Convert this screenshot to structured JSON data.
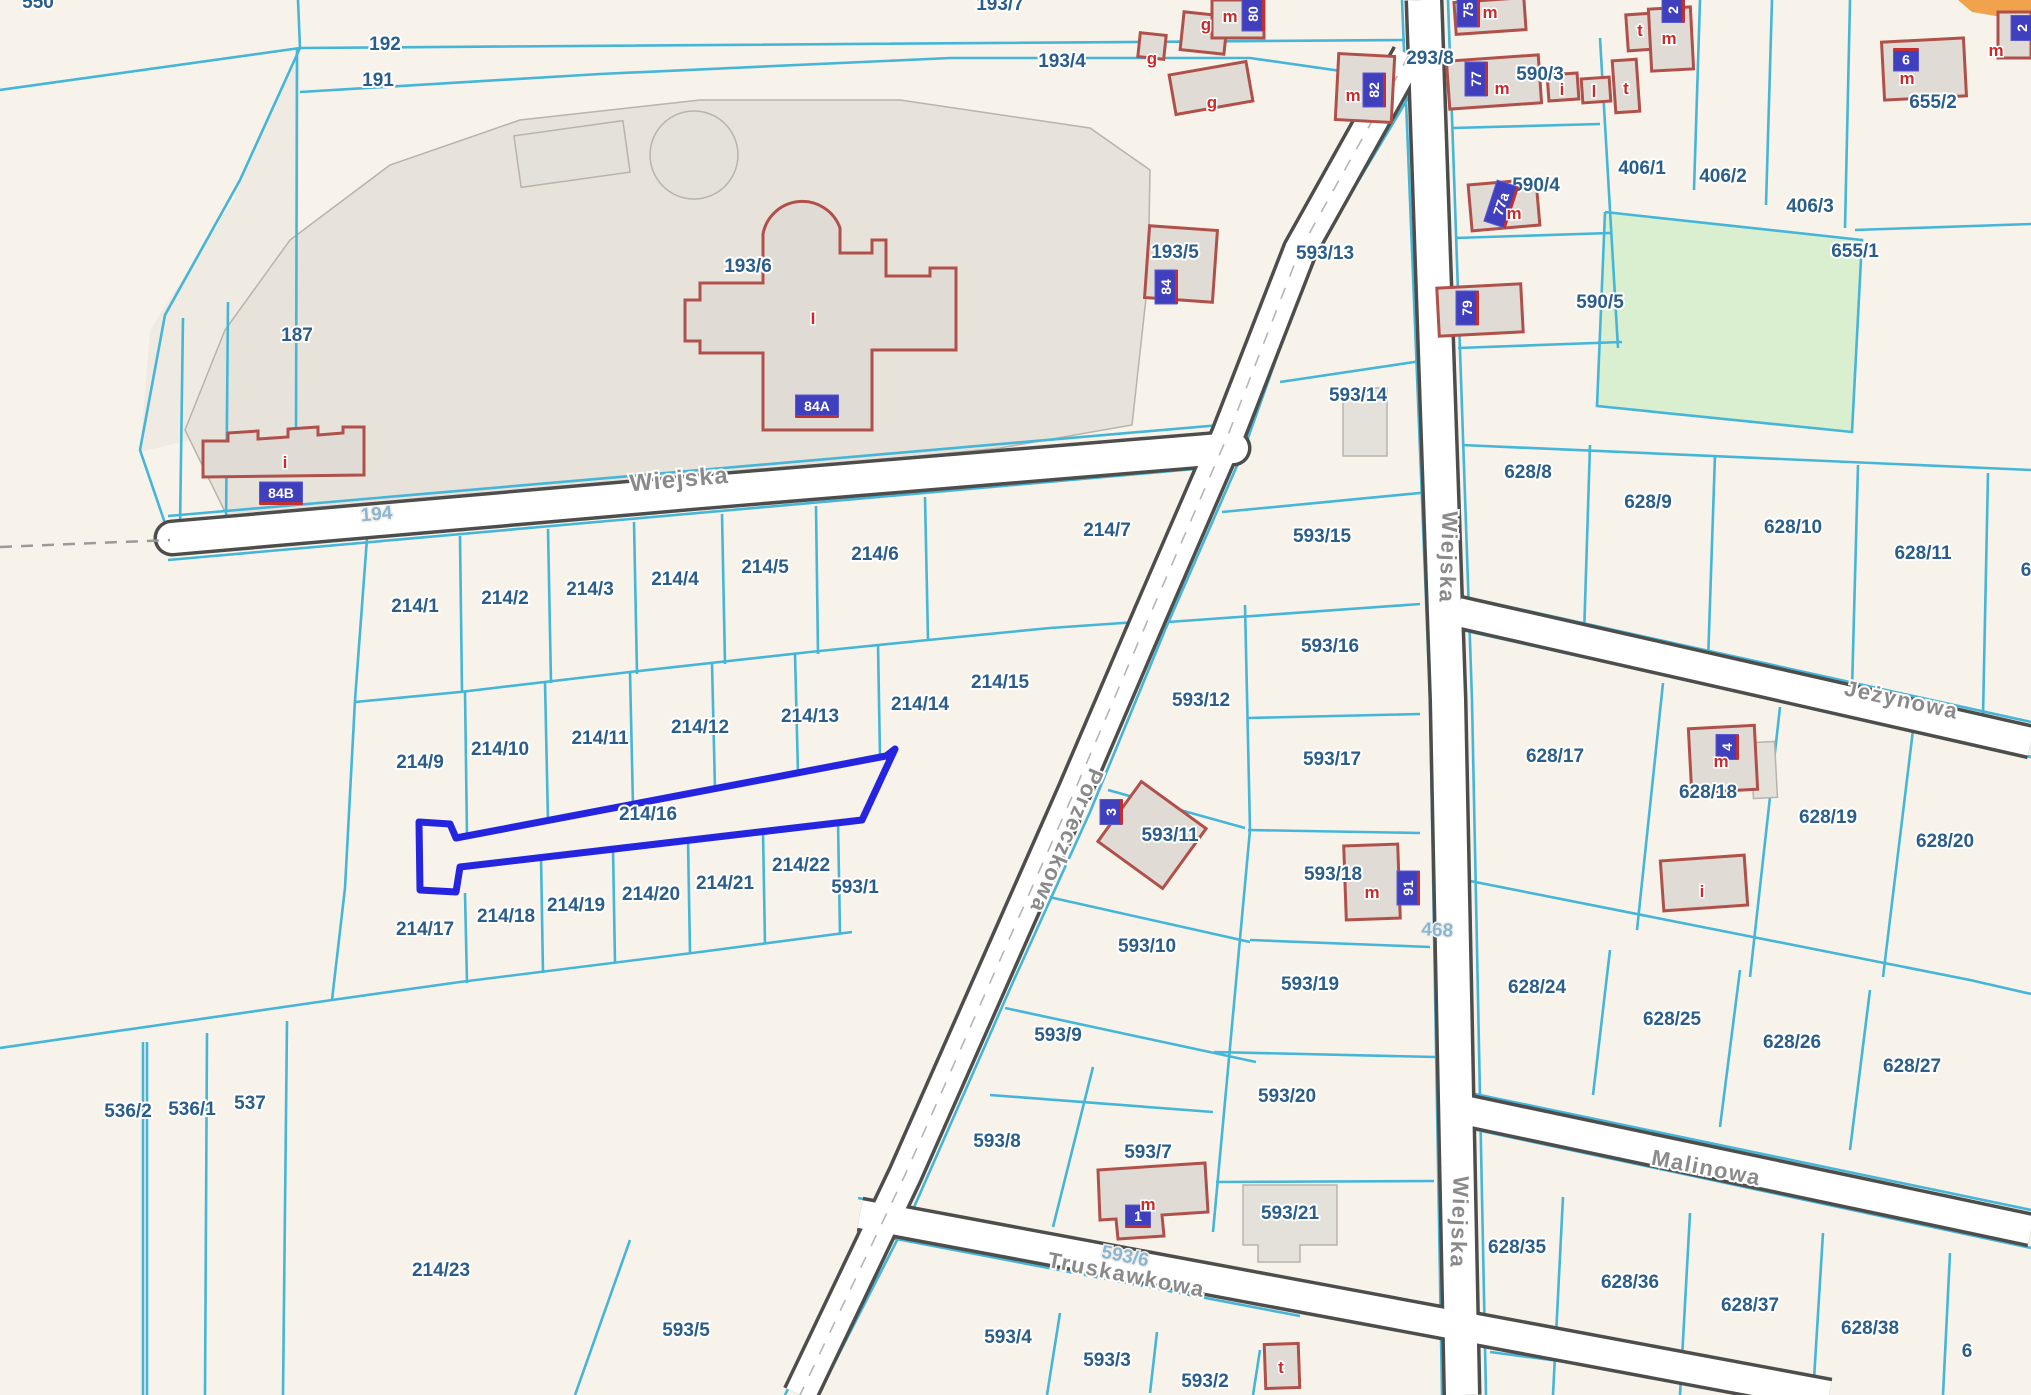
{
  "map": {
    "title": "cadastral-parcel-map",
    "highlighted_parcel": "214/16",
    "colors": {
      "background": "#f7f3ea",
      "parcel_line": "#45b5d8",
      "parcel_label": "#2a5d8a",
      "road_number": "#8ab6d6",
      "street_label": "#8a8a8a",
      "road_casing": "#4d4d4b",
      "road_fill": "#ffffff",
      "building_outline": "#b0504a",
      "building_fill": "#e0dbd4",
      "gray_outline": "#b8b4ac",
      "gray_region": "#e7e3db",
      "region_187": "#efebe3",
      "green_area": "#d9efcf",
      "orange_road": "#f0a34c",
      "highlight": "#2525e0",
      "badge_bg": "#4040bf"
    },
    "parcel_labels": [
      {
        "text": "550",
        "x": 38,
        "y": 8
      },
      {
        "text": "192",
        "x": 385,
        "y": 50
      },
      {
        "text": "191",
        "x": 378,
        "y": 86
      },
      {
        "text": "193/7",
        "x": 1000,
        "y": 10
      },
      {
        "text": "193/4",
        "x": 1062,
        "y": 67
      },
      {
        "text": "193/6",
        "x": 748,
        "y": 272
      },
      {
        "text": "187",
        "x": 297,
        "y": 341
      },
      {
        "text": "193/5",
        "x": 1175,
        "y": 258
      },
      {
        "text": "593/13",
        "x": 1325,
        "y": 259
      },
      {
        "text": "293/8",
        "x": 1430,
        "y": 64
      },
      {
        "text": "590/3",
        "x": 1540,
        "y": 80
      },
      {
        "text": "590/4",
        "x": 1536,
        "y": 191
      },
      {
        "text": "590/5",
        "x": 1600,
        "y": 308
      },
      {
        "text": "406/1",
        "x": 1642,
        "y": 174
      },
      {
        "text": "406/2",
        "x": 1723,
        "y": 182
      },
      {
        "text": "406/3",
        "x": 1810,
        "y": 212
      },
      {
        "text": "655/2",
        "x": 1933,
        "y": 108
      },
      {
        "text": "655/1",
        "x": 1855,
        "y": 257
      },
      {
        "text": "628/8",
        "x": 1528,
        "y": 478
      },
      {
        "text": "628/9",
        "x": 1648,
        "y": 508
      },
      {
        "text": "628/10",
        "x": 1793,
        "y": 533
      },
      {
        "text": "628/11",
        "x": 1923,
        "y": 559
      },
      {
        "text": "6",
        "x": 2026,
        "y": 576
      },
      {
        "text": "593/14",
        "x": 1358,
        "y": 401
      },
      {
        "text": "593/15",
        "x": 1322,
        "y": 542
      },
      {
        "text": "214/7",
        "x": 1107,
        "y": 536
      },
      {
        "text": "214/1",
        "x": 415,
        "y": 612
      },
      {
        "text": "214/2",
        "x": 505,
        "y": 604
      },
      {
        "text": "214/3",
        "x": 590,
        "y": 595
      },
      {
        "text": "214/4",
        "x": 675,
        "y": 585
      },
      {
        "text": "214/5",
        "x": 765,
        "y": 573
      },
      {
        "text": "214/6",
        "x": 875,
        "y": 560
      },
      {
        "text": "214/15",
        "x": 1000,
        "y": 688
      },
      {
        "text": "593/12",
        "x": 1201,
        "y": 706
      },
      {
        "text": "593/16",
        "x": 1330,
        "y": 652
      },
      {
        "text": "593/17",
        "x": 1332,
        "y": 765
      },
      {
        "text": "628/17",
        "x": 1555,
        "y": 762
      },
      {
        "text": "628/18",
        "x": 1708,
        "y": 798
      },
      {
        "text": "628/19",
        "x": 1828,
        "y": 823
      },
      {
        "text": "628/20",
        "x": 1945,
        "y": 847
      },
      {
        "text": "214/9",
        "x": 420,
        "y": 768
      },
      {
        "text": "214/10",
        "x": 500,
        "y": 755
      },
      {
        "text": "214/11",
        "x": 600,
        "y": 744
      },
      {
        "text": "214/12",
        "x": 700,
        "y": 733
      },
      {
        "text": "214/13",
        "x": 810,
        "y": 722
      },
      {
        "text": "214/14",
        "x": 920,
        "y": 710
      },
      {
        "text": "214/16",
        "x": 648,
        "y": 820
      },
      {
        "text": "593/11",
        "x": 1170,
        "y": 841
      },
      {
        "text": "593/18",
        "x": 1333,
        "y": 880
      },
      {
        "text": "214/17",
        "x": 425,
        "y": 935
      },
      {
        "text": "214/18",
        "x": 506,
        "y": 922
      },
      {
        "text": "214/19",
        "x": 576,
        "y": 911
      },
      {
        "text": "214/20",
        "x": 651,
        "y": 900
      },
      {
        "text": "214/21",
        "x": 725,
        "y": 889
      },
      {
        "text": "214/22",
        "x": 801,
        "y": 871
      },
      {
        "text": "593/10",
        "x": 1147,
        "y": 952
      },
      {
        "text": "593/19",
        "x": 1310,
        "y": 990
      },
      {
        "text": "628/24",
        "x": 1537,
        "y": 993
      },
      {
        "text": "628/25",
        "x": 1672,
        "y": 1025
      },
      {
        "text": "628/26",
        "x": 1792,
        "y": 1048
      },
      {
        "text": "628/27",
        "x": 1912,
        "y": 1072
      },
      {
        "text": "536/2",
        "x": 128,
        "y": 1117
      },
      {
        "text": "536/1",
        "x": 192,
        "y": 1115
      },
      {
        "text": "537",
        "x": 250,
        "y": 1109
      },
      {
        "text": "593/9",
        "x": 1058,
        "y": 1041
      },
      {
        "text": "593/8",
        "x": 997,
        "y": 1147
      },
      {
        "text": "593/7",
        "x": 1148,
        "y": 1158
      },
      {
        "text": "593/20",
        "x": 1287,
        "y": 1102
      },
      {
        "text": "593/21",
        "x": 1290,
        "y": 1219
      },
      {
        "text": "214/23",
        "x": 441,
        "y": 1276
      },
      {
        "text": "628/35",
        "x": 1517,
        "y": 1253
      },
      {
        "text": "628/36",
        "x": 1630,
        "y": 1288
      },
      {
        "text": "628/37",
        "x": 1750,
        "y": 1311
      },
      {
        "text": "628/38",
        "x": 1870,
        "y": 1334
      },
      {
        "text": "6",
        "x": 1967,
        "y": 1357
      },
      {
        "text": "593/5",
        "x": 686,
        "y": 1336
      },
      {
        "text": "593/4",
        "x": 1008,
        "y": 1343
      },
      {
        "text": "593/3",
        "x": 1107,
        "y": 1366
      },
      {
        "text": "593/2",
        "x": 1205,
        "y": 1387
      }
    ],
    "under_road_labels": [
      {
        "text": "593/1",
        "x": 855,
        "y": 893
      }
    ],
    "street_labels": [
      {
        "text": "Wiejska",
        "x": 680,
        "y": 487,
        "rot": -5,
        "size": 24
      },
      {
        "text": "Wiejska",
        "x": 1441,
        "y": 557,
        "rot": 92,
        "size": 22
      },
      {
        "text": "Wiejska",
        "x": 1452,
        "y": 1222,
        "rot": 92,
        "size": 22
      },
      {
        "text": "Porzeczkowa",
        "x": 1060,
        "y": 838,
        "rot": 113,
        "size": 22
      },
      {
        "text": "Jeżynowa",
        "x": 1900,
        "y": 707,
        "rot": 12,
        "size": 22
      },
      {
        "text": "Malinowa",
        "x": 1705,
        "y": 1175,
        "rot": 11,
        "size": 22
      },
      {
        "text": "Truskawkowa",
        "x": 1125,
        "y": 1282,
        "rot": 11,
        "size": 22
      }
    ],
    "road_numbers": [
      {
        "text": "194",
        "x": 377,
        "y": 520,
        "rot": -5
      },
      {
        "text": "468",
        "x": 1437,
        "y": 936,
        "rot": 3
      },
      {
        "text": "593/6",
        "x": 1124,
        "y": 1262,
        "rot": 11
      }
    ],
    "badges": [
      {
        "text": "84A",
        "x": 817,
        "y": 406,
        "rot": 0
      },
      {
        "text": "84B",
        "x": 281,
        "y": 493,
        "rot": 0
      },
      {
        "text": "84",
        "x": 1166,
        "y": 287,
        "rot": -90
      },
      {
        "text": "80",
        "x": 1253,
        "y": 14,
        "rot": -90
      },
      {
        "text": "82",
        "x": 1374,
        "y": 90,
        "rot": -90
      },
      {
        "text": "75",
        "x": 1468,
        "y": 10,
        "rot": -90
      },
      {
        "text": "77",
        "x": 1476,
        "y": 79,
        "rot": -90
      },
      {
        "text": "77a",
        "x": 1501,
        "y": 204,
        "rot": -72
      },
      {
        "text": "79",
        "x": 1467,
        "y": 308,
        "rot": -90
      },
      {
        "text": "2",
        "x": 1673,
        "y": 10,
        "rot": -90
      },
      {
        "text": "9",
        "x": 1906,
        "y": 60,
        "rot": 180
      },
      {
        "text": "2",
        "x": 2022,
        "y": 28,
        "rot": -90
      },
      {
        "text": "3",
        "x": 1111,
        "y": 812,
        "rot": -90
      },
      {
        "text": "91",
        "x": 1408,
        "y": 888,
        "rot": -90
      },
      {
        "text": "4",
        "x": 1727,
        "y": 747,
        "rot": -90
      },
      {
        "text": "1",
        "x": 1138,
        "y": 1216,
        "rot": 0
      }
    ],
    "building_letters": [
      {
        "text": "m",
        "x": 1230,
        "y": 16
      },
      {
        "text": "m",
        "x": 1353,
        "y": 95
      },
      {
        "text": "m",
        "x": 1490,
        "y": 12
      },
      {
        "text": "m",
        "x": 1502,
        "y": 88
      },
      {
        "text": "m",
        "x": 1514,
        "y": 213
      },
      {
        "text": "m",
        "x": 1669,
        "y": 38
      },
      {
        "text": "m",
        "x": 1907,
        "y": 78
      },
      {
        "text": "m",
        "x": 1996,
        "y": 50
      },
      {
        "text": "m",
        "x": 1372,
        "y": 892
      },
      {
        "text": "m",
        "x": 1721,
        "y": 761
      },
      {
        "text": "m",
        "x": 1148,
        "y": 1204
      },
      {
        "text": "g",
        "x": 1206,
        "y": 24
      },
      {
        "text": "g",
        "x": 1152,
        "y": 58
      },
      {
        "text": "g",
        "x": 1212,
        "y": 102
      },
      {
        "text": "t",
        "x": 1640,
        "y": 30
      },
      {
        "text": "t",
        "x": 1626,
        "y": 88
      },
      {
        "text": "t",
        "x": 1281,
        "y": 1367
      },
      {
        "text": "i",
        "x": 285,
        "y": 462
      },
      {
        "text": "i",
        "x": 1562,
        "y": 89
      },
      {
        "text": "i",
        "x": 1702,
        "y": 891
      },
      {
        "text": "l",
        "x": 1594,
        "y": 91
      },
      {
        "text": "I",
        "x": 813,
        "y": 318
      }
    ]
  }
}
